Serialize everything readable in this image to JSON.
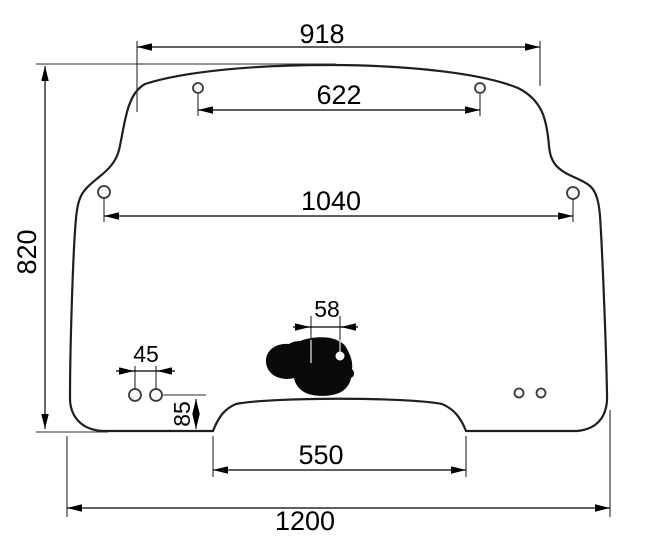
{
  "drawing": {
    "type": "technical-dimension-drawing",
    "subject": "cab glass panel with mounting holes, wiper motor cutout and bottom notch",
    "labels": {
      "top_width": "918",
      "upper_hole_span": "622",
      "mid_hole_span": "1040",
      "wiper_hole_span": "58",
      "small_hole_span": "45",
      "hole_edge_offset": "85",
      "notch_width": "550",
      "overall_width": "1200",
      "overall_height": "820"
    },
    "colors": {
      "glass_fill": "#d8f3f8",
      "outline": "#1f1f1f",
      "dimension_lines": "#000000",
      "cutout_fill": "#0a0a0a"
    }
  }
}
